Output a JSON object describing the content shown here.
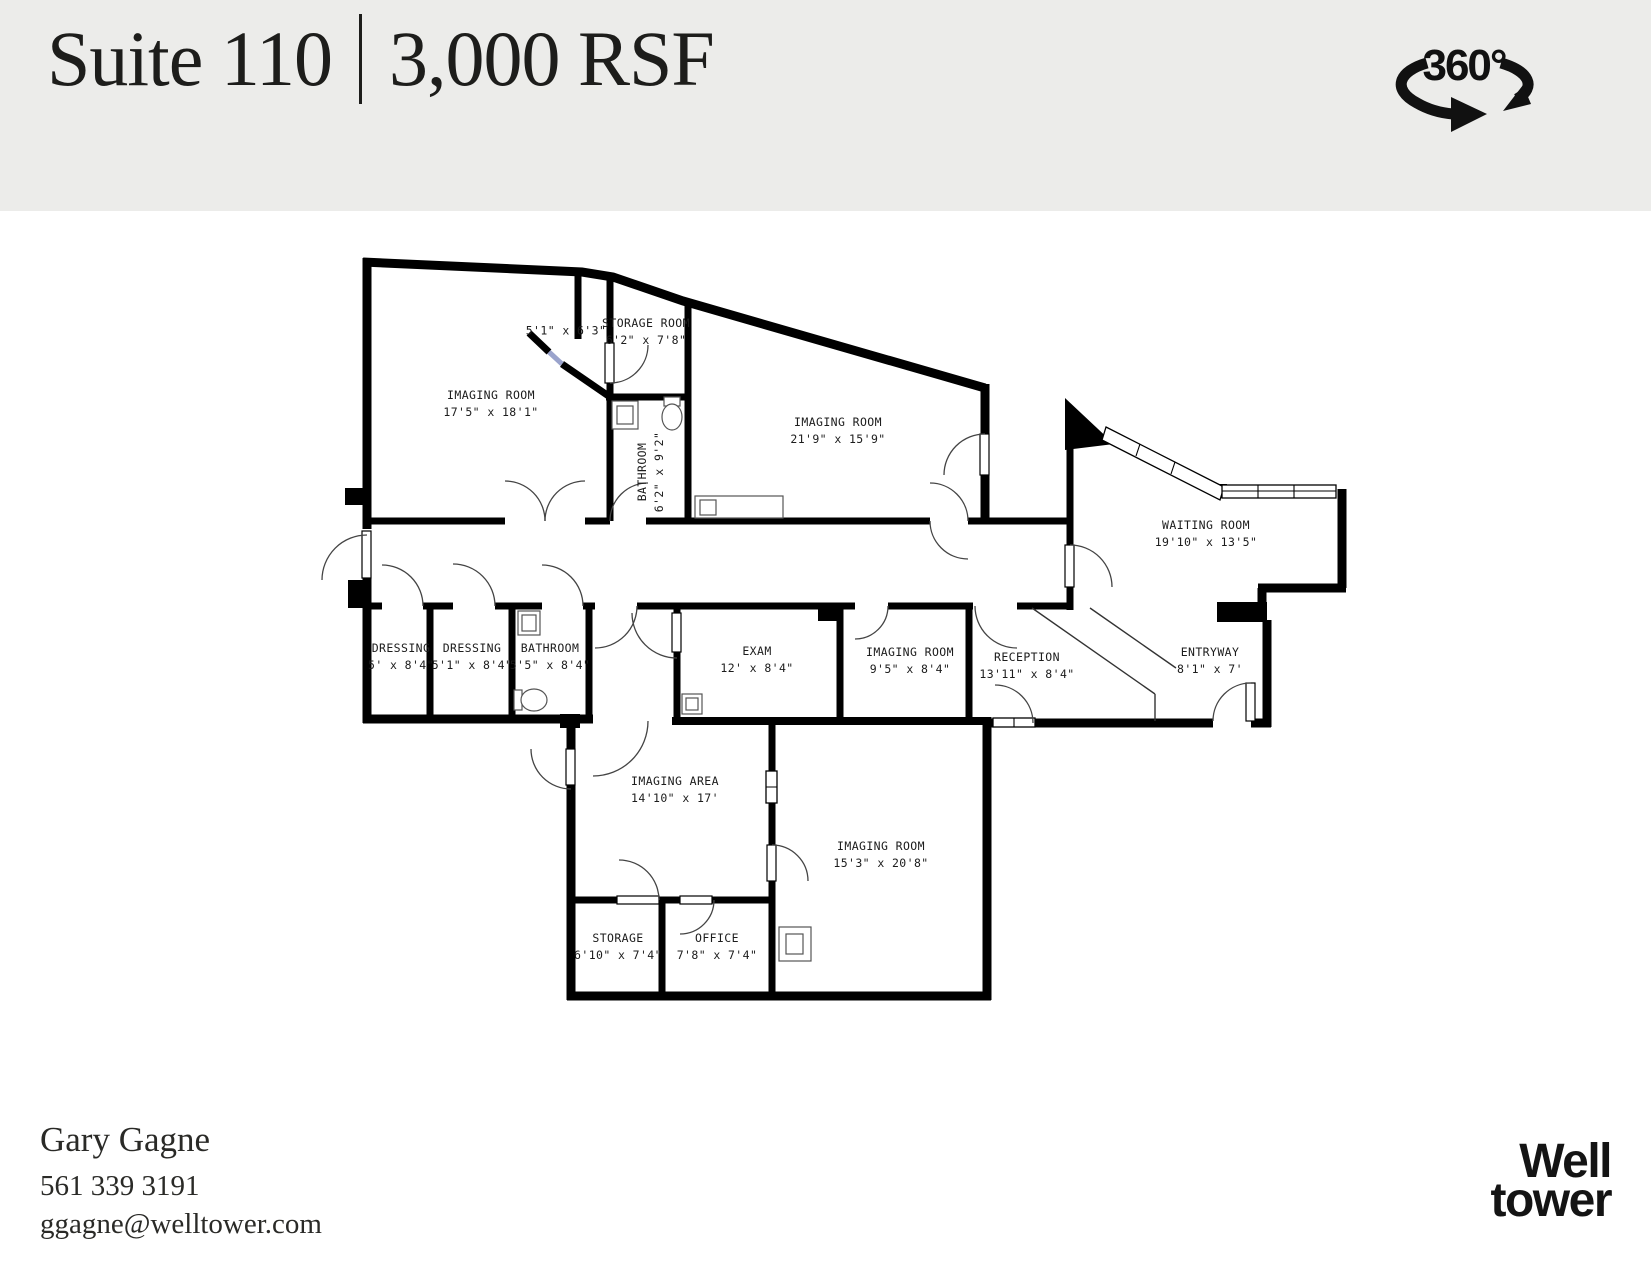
{
  "header": {
    "suite": "Suite 110",
    "area": "3,000 RSF",
    "badge": "360°"
  },
  "plan": {
    "rooms": [
      {
        "name": "IMAGING ROOM",
        "dims": "17'5\" x 18'1\""
      },
      {
        "name": "",
        "dims": "5'1\" x 6'3\""
      },
      {
        "name": "STORAGE ROOM",
        "dims": "6'2\" x 7'8\""
      },
      {
        "name": "BATHROOM",
        "dims": "6'2\" x 9'2\""
      },
      {
        "name": "IMAGING ROOM",
        "dims": "21'9\" x 15'9\""
      },
      {
        "name": "WAITING ROOM",
        "dims": "19'10\" x 13'5\""
      },
      {
        "name": "DRESSING",
        "dims": "5' x 8'4\""
      },
      {
        "name": "DRESSING",
        "dims": "5'1\" x 8'4\""
      },
      {
        "name": "BATHROOM",
        "dims": "5'5\" x 8'4\""
      },
      {
        "name": "EXAM",
        "dims": "12' x 8'4\""
      },
      {
        "name": "IMAGING ROOM",
        "dims": "9'5\" x 8'4\""
      },
      {
        "name": "RECEPTION",
        "dims": "13'11\" x 8'4\""
      },
      {
        "name": "ENTRYWAY",
        "dims": "8'1\" x 7'"
      },
      {
        "name": "IMAGING AREA",
        "dims": "14'10\" x 17'"
      },
      {
        "name": "IMAGING ROOM",
        "dims": "15'3\" x 20'8\""
      },
      {
        "name": "STORAGE",
        "dims": "6'10\" x 7'4\""
      },
      {
        "name": "OFFICE",
        "dims": "7'8\" x 7'4\""
      }
    ]
  },
  "contact": {
    "name": "Gary Gagne",
    "phone": "561 339 3191",
    "email": "ggagne@welltower.com"
  },
  "logo": {
    "line1": "Well",
    "line2": "tower"
  },
  "colors": {
    "band": "#ECECEA",
    "ink": "#1d1d1b",
    "wall": "#000000"
  }
}
